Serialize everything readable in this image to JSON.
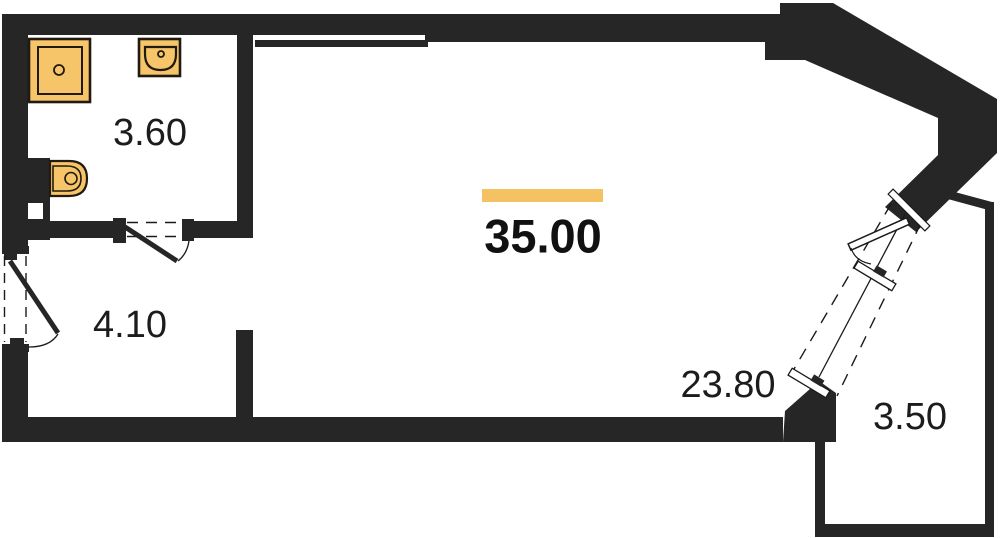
{
  "plan": {
    "type": "apartment-floor-plan",
    "total_area": "35.00",
    "rooms": [
      {
        "id": "bathroom",
        "area": "3.60"
      },
      {
        "id": "hallway",
        "area": "4.10"
      },
      {
        "id": "living-room",
        "area": "23.80"
      },
      {
        "id": "balcony",
        "area": "3.50"
      }
    ],
    "fixtures": [
      "shower-tray",
      "sink",
      "toilet"
    ],
    "doors": [
      "entrance-door",
      "bathroom-door",
      "balcony-door"
    ]
  },
  "colors": {
    "wall": "#262626",
    "line": "#1a1a1a",
    "fixture_fill": "#F6C469",
    "accent_bar": "#F5C263",
    "background": "#ffffff",
    "label_text": "#1c1c1c"
  }
}
